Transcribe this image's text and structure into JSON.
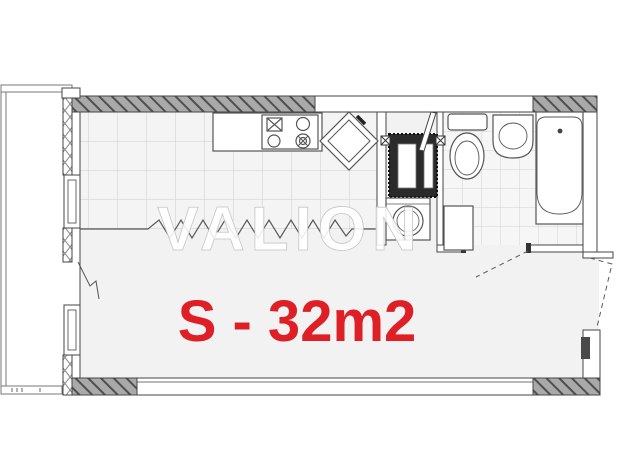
{
  "plan": {
    "watermark": "VALION",
    "area_label": "S - 32m2",
    "colors": {
      "area_label": "#de1f26",
      "watermark": "#ffffff",
      "wall_hatch_fill": "#a9a9a9",
      "wall_line": "#454545",
      "floor": "#f2f2f2"
    },
    "fixtures": [
      "balcony",
      "balcony-door",
      "window-left-upper",
      "window-left-lower",
      "window-bottom",
      "kitchen-counter",
      "stove",
      "kitchen-sink",
      "ventilation-shaft",
      "washing-machine",
      "hall-cabinet",
      "toilet",
      "washbasin",
      "bathtub",
      "bathroom-door",
      "entrance-door"
    ]
  }
}
